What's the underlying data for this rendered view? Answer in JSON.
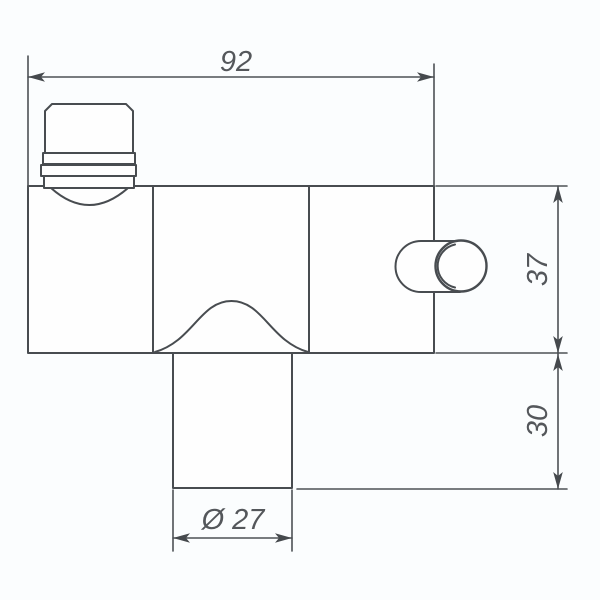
{
  "drawing": {
    "dimensions": {
      "width": "92",
      "body_height": "37",
      "outlet_height": "30",
      "diameter": "Ø 27"
    },
    "colors": {
      "line": "#484c50",
      "dimension_line": "#4d5155",
      "text": "#54575b",
      "background": "#fbfdfe",
      "shape_fill": "#fefefe"
    }
  }
}
